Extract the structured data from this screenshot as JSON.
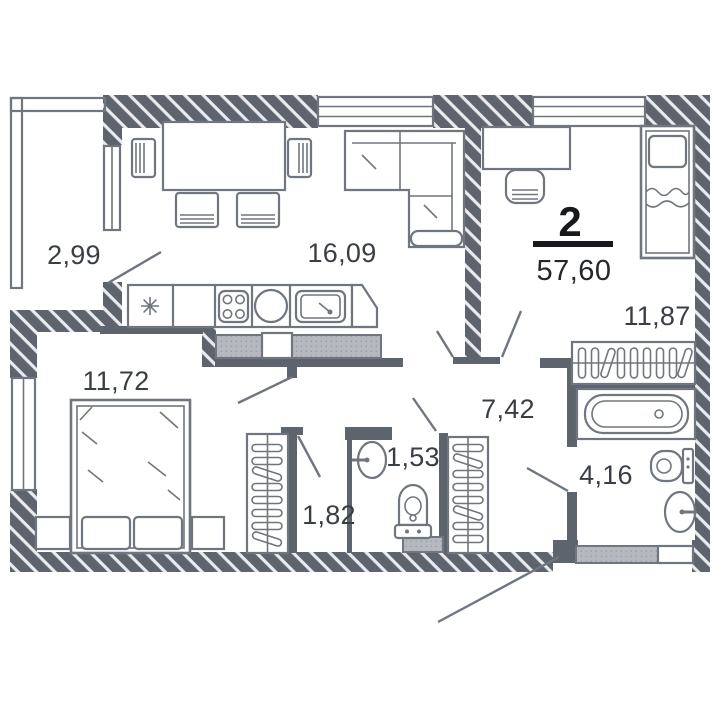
{
  "page": {
    "background": "#ffffff"
  },
  "floor_plan": {
    "apartment": {
      "number": "2",
      "total_area": "57,60"
    },
    "rooms": [
      {
        "name": "balcony",
        "area": "2,99"
      },
      {
        "name": "kitchen-living-room",
        "area": "16,09"
      },
      {
        "name": "bedroom-1",
        "area": "11,72"
      },
      {
        "name": "bedroom-2",
        "area": "11,87"
      },
      {
        "name": "hallway",
        "area": "7,42"
      },
      {
        "name": "wc",
        "area": "1,53"
      },
      {
        "name": "wardrobe-closet",
        "area": "1,82"
      },
      {
        "name": "bathroom",
        "area": "4,16"
      }
    ],
    "colors": {
      "wall": "#5d646e",
      "furniture_line": "#70767f",
      "label_text": "#393e45",
      "apartment_number": "#17191d",
      "vent_shaft_fill": "#b5b8be",
      "background": "#ffffff"
    }
  }
}
